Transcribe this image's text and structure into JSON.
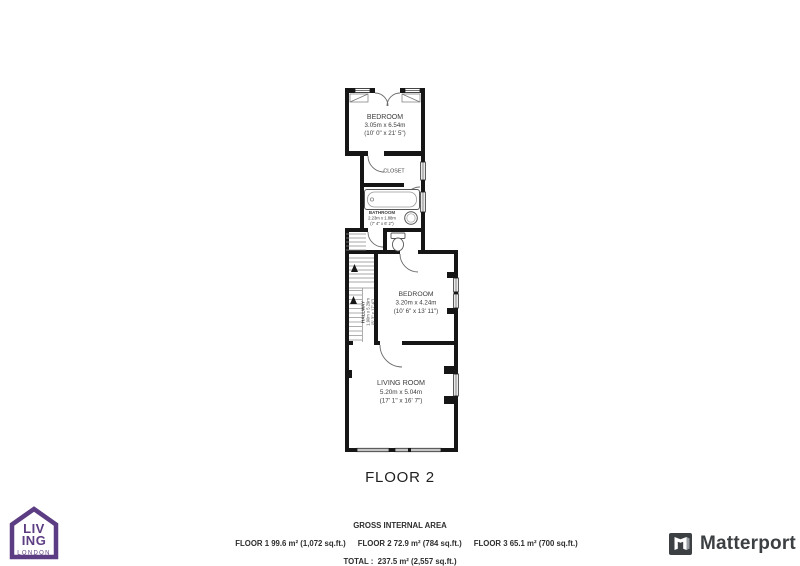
{
  "plan": {
    "floor_label": "FLOOR 2",
    "rooms": {
      "bedroom1": {
        "name": "BEDROOM",
        "metric": "3.05m x 6.54m",
        "imperial": "(10' 0\" x 21' 5\")"
      },
      "closet": {
        "name": "CLOSET"
      },
      "bathroom": {
        "name": "BATHROOM",
        "metric": "2.23m x 1.88m",
        "imperial": "(7' 4\" x 6' 2\")"
      },
      "hallway": {
        "name": "HALLWAY",
        "metric": "1.90m x 5.29m",
        "imperial": "(6' 3\" x 17' 4\")"
      },
      "bedroom2": {
        "name": "BEDROOM",
        "metric": "3.20m x 4.24m",
        "imperial": "(10' 6\" x 13' 11\")"
      },
      "living_room": {
        "name": "LIVING ROOM",
        "metric": "5.20m x 5.04m",
        "imperial": "(17' 1\" x 16' 7\")"
      }
    }
  },
  "footer": {
    "title": "GROSS INTERNAL AREA",
    "floor1": "FLOOR 1 99.6 m² (1,072 sq.ft.)",
    "floor2": "FLOOR 2 72.9 m² (784 sq.ft.)",
    "floor3": "FLOOR 3 65.1 m² (700 sq.ft.)",
    "total": "TOTAL :  237.5 m² (2,557 sq.ft.)",
    "disclaimer": "SIZES AND DIMENSIONS ARE APPROXIMATE, ACTUAL MAY VARY."
  },
  "logos": {
    "living_london": {
      "line1": "LIV",
      "line2": "ING",
      "line3": "LONDON",
      "color": "#5c3c82"
    },
    "matterport": {
      "label": "Matterport",
      "color": "#3d4043"
    }
  },
  "colors": {
    "wall": "#161616",
    "room_text": "#3c3c3c"
  }
}
